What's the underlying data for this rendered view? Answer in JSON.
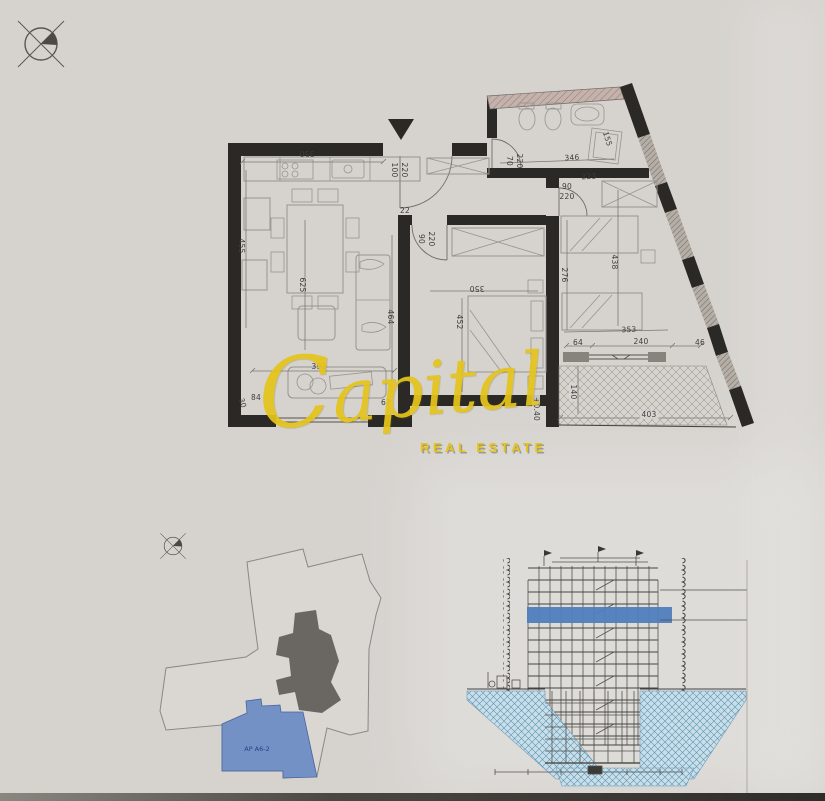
{
  "colors": {
    "paper": "#d6d3cf",
    "paperlight": "#e5e4e0",
    "wall": "#2b2925",
    "furniture": "#97948c",
    "yellow": "#e5c41c",
    "blue": "#7491c5",
    "core": "#6a6763",
    "band": "#4f7dbd",
    "dimtext": "#3f3d39",
    "edge": "#2f2d2a"
  },
  "watermark": {
    "brand": "Capital",
    "tagline": "REAL ESTATE"
  },
  "site_plan": {
    "apartment_label": "AP A6-2"
  },
  "floor_plan": {
    "level_label": "+0.40",
    "dimensions": [
      {
        "t": "350",
        "x": 307,
        "y": 153,
        "r": 180
      },
      {
        "t": "100",
        "x": 394,
        "y": 170,
        "r": 90
      },
      {
        "t": "220",
        "x": 404,
        "y": 170,
        "r": 90
      },
      {
        "t": "22",
        "x": 405,
        "y": 211,
        "r": 0
      },
      {
        "t": "90",
        "x": 421,
        "y": 239,
        "r": 90
      },
      {
        "t": "220",
        "x": 431,
        "y": 239,
        "r": 90
      },
      {
        "t": "70",
        "x": 509,
        "y": 161,
        "r": 90
      },
      {
        "t": "220",
        "x": 519,
        "y": 161,
        "r": 90
      },
      {
        "t": "346",
        "x": 572,
        "y": 158,
        "r": -3
      },
      {
        "t": "223",
        "x": 589,
        "y": 177,
        "r": -3
      },
      {
        "t": "90",
        "x": 567,
        "y": 187,
        "r": 0
      },
      {
        "t": "220",
        "x": 567,
        "y": 197,
        "r": 0
      },
      {
        "t": "155",
        "x": 607,
        "y": 139,
        "r": 73
      },
      {
        "t": "455",
        "x": 241,
        "y": 246,
        "r": 90
      },
      {
        "t": "625",
        "x": 302,
        "y": 285,
        "r": 90
      },
      {
        "t": "464",
        "x": 390,
        "y": 317,
        "r": 90
      },
      {
        "t": "350",
        "x": 477,
        "y": 288,
        "r": 180
      },
      {
        "t": "452",
        "x": 459,
        "y": 322,
        "r": 90
      },
      {
        "t": "276",
        "x": 564,
        "y": 275,
        "r": 90
      },
      {
        "t": "438",
        "x": 614,
        "y": 262,
        "r": 90
      },
      {
        "t": "353",
        "x": 629,
        "y": 330,
        "r": -2
      },
      {
        "t": "64",
        "x": 578,
        "y": 343,
        "r": 0
      },
      {
        "t": "240",
        "x": 641,
        "y": 342,
        "r": 0
      },
      {
        "t": "46",
        "x": 700,
        "y": 343,
        "r": 0
      },
      {
        "t": "140",
        "x": 573,
        "y": 392,
        "r": 90,
        "bg": true
      },
      {
        "t": "403",
        "x": 649,
        "y": 415,
        "r": 0,
        "bg": true
      },
      {
        "t": "+0.40",
        "x": 536,
        "y": 409,
        "r": 90,
        "bg": true
      },
      {
        "t": "391",
        "x": 319,
        "y": 367,
        "r": 0
      },
      {
        "t": "84",
        "x": 256,
        "y": 398,
        "r": 0
      },
      {
        "t": "67",
        "x": 386,
        "y": 403,
        "r": 0
      },
      {
        "t": "30",
        "x": 242,
        "y": 403,
        "r": 73
      }
    ]
  }
}
